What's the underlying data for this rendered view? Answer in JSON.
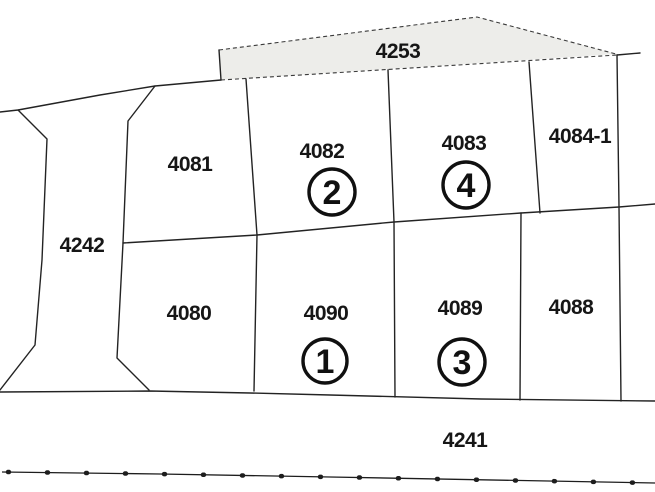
{
  "canvas": {
    "background": "#ffffff",
    "line_color": "#232323",
    "shaded_parcel_fill": "#ededea"
  },
  "parcels": {
    "p4253": {
      "label": "4253"
    },
    "p4242": {
      "label": "4242"
    },
    "p4081": {
      "label": "4081"
    },
    "p4082": {
      "label": "4082",
      "circled": "2"
    },
    "p4083": {
      "label": "4083",
      "circled": "4"
    },
    "p4084_1": {
      "label": "4084-1"
    },
    "p4080": {
      "label": "4080"
    },
    "p4090": {
      "label": "4090",
      "circled": "1"
    },
    "p4089": {
      "label": "4089",
      "circled": "3"
    },
    "p4088": {
      "label": "4088"
    },
    "p4241": {
      "label": "4241"
    }
  }
}
